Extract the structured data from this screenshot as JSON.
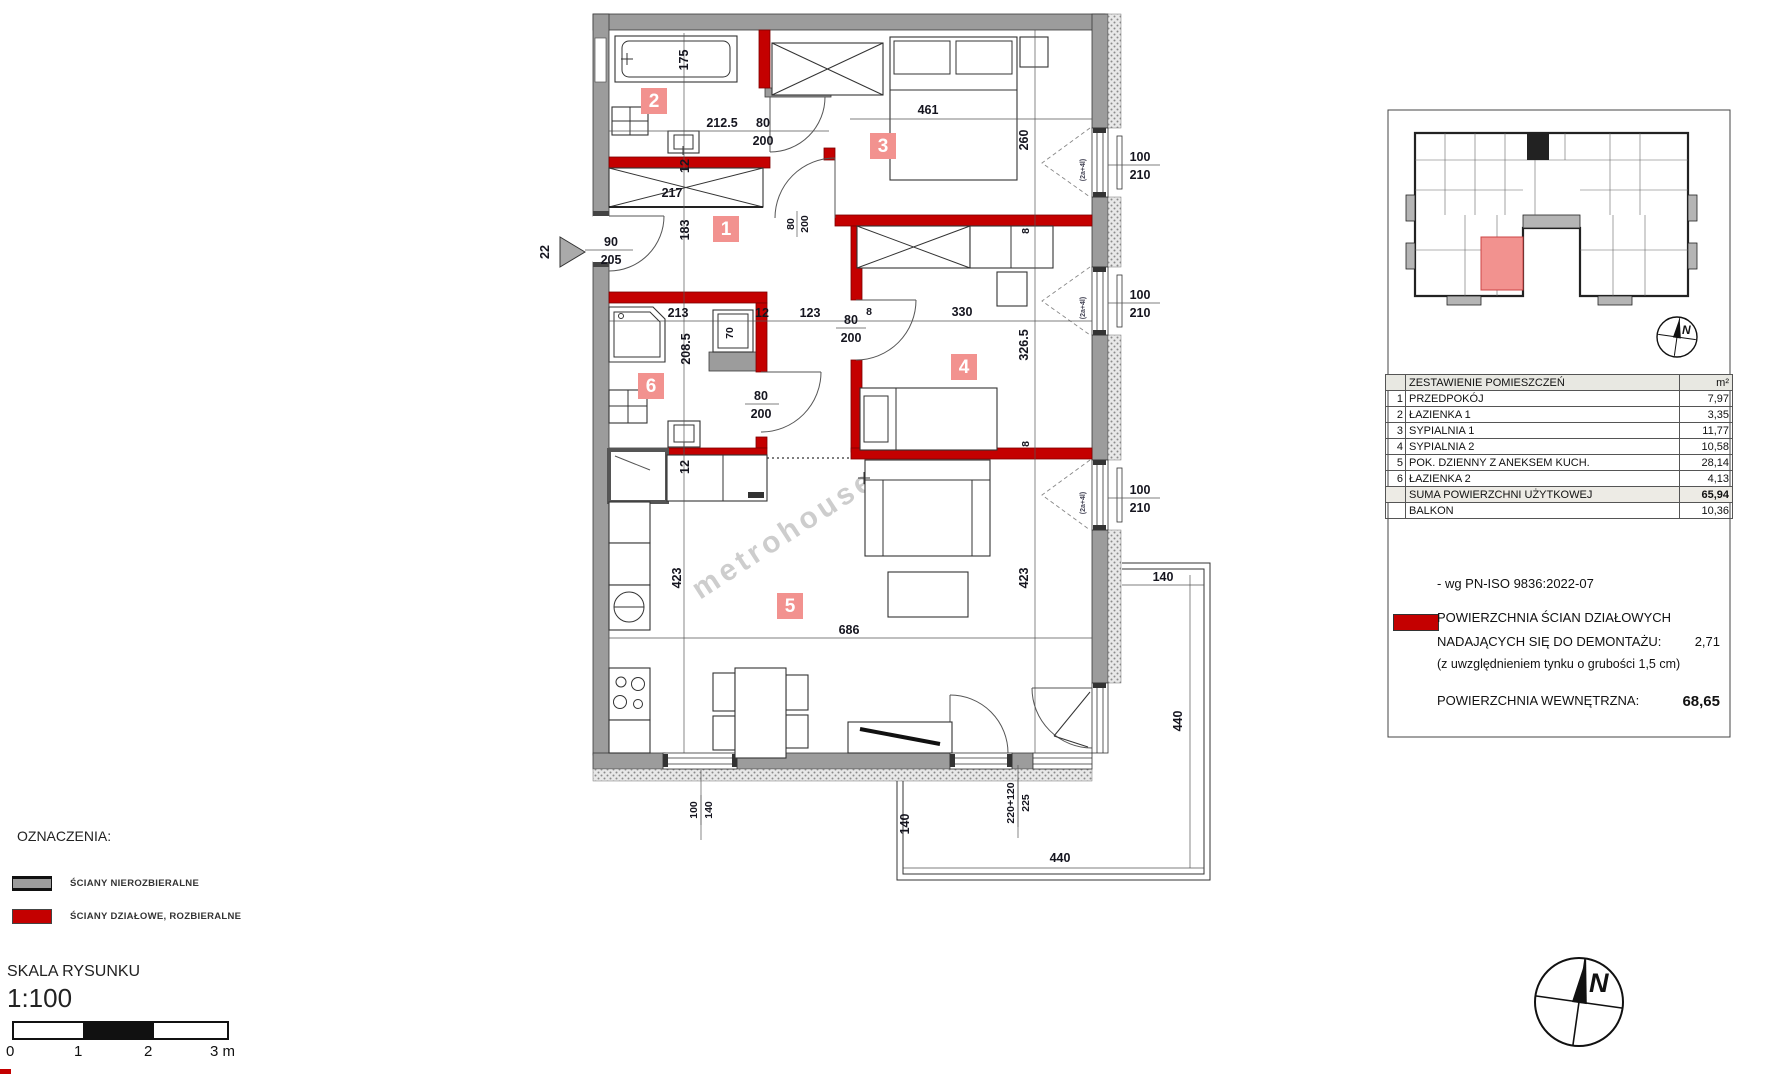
{
  "watermark": "metrohouse",
  "plan": {
    "badges": {
      "b1": "1",
      "b2": "2",
      "b3": "3",
      "b4": "4",
      "b5": "5",
      "b6": "6"
    },
    "labels": {
      "tub": "175",
      "w2125": "212.5",
      "w217": "217",
      "t12": "12",
      "h183": "183",
      "w213": "213",
      "h2085": "208.5",
      "wm70": "70",
      "w123": "123",
      "w461": "461",
      "h260": "260",
      "w330": "330",
      "h3265": "326.5",
      "t8": "8",
      "h423": "423",
      "w686": "686",
      "b_top": "140",
      "b_right": "440",
      "b_bottom": "440",
      "b_left": "140"
    },
    "doors": {
      "w80": "80",
      "h200": "200",
      "e90": "90",
      "e205": "205",
      "no22": "22",
      "win_w": "100",
      "win_h": "210",
      "bw_w": "100",
      "bw_h": "140",
      "bd_top": "220+120",
      "bd_bot": "225",
      "win_note": "(2a+4l)"
    }
  },
  "panel": {
    "table": {
      "header": {
        "name": "ZESTAWIENIE POMIESZCZEŃ",
        "unit": "m²"
      },
      "rows": [
        {
          "no": "1",
          "name": "PRZEDPOKÓJ",
          "area": "7,97"
        },
        {
          "no": "2",
          "name": "ŁAZIENKA 1",
          "area": "3,35"
        },
        {
          "no": "3",
          "name": "SYPIALNIA 1",
          "area": "11,77"
        },
        {
          "no": "4",
          "name": "SYPIALNIA 2",
          "area": "10,58"
        },
        {
          "no": "5",
          "name": "POK. DZIENNY Z ANEKSEM KUCH.",
          "area": "28,14"
        },
        {
          "no": "6",
          "name": "ŁAZIENKA 2",
          "area": "4,13"
        }
      ],
      "sum": {
        "name": "SUMA POWIERZCHNI UŻYTKOWEJ",
        "area": "65,94"
      },
      "balkon": {
        "name": "BALKON",
        "area": "10,36"
      }
    },
    "notes": {
      "norm": "- wg PN-ISO 9836:2022-07",
      "demontaz1": "POWIERZCHNIA ŚCIAN DZIAŁOWYCH",
      "demontaz2": "NADAJĄCYCH SIĘ DO DEMONTAŻU:",
      "demontaz_val": "2,71",
      "demontaz3": "(z uwzględnieniem tynku o grubości 1,5 cm)",
      "internal": "POWIERZCHNIA WEWNĘTRZNA:",
      "internal_val": "68,65"
    },
    "compass_n": "N"
  },
  "legend": {
    "title": "OZNACZENIA:",
    "items": [
      {
        "label": "ŚCIANY NIEROZBIERALNE"
      },
      {
        "label": "ŚCIANY DZIAŁOWE, ROZBIERALNE"
      }
    ],
    "scale_title": "SKALA RYSUNKU",
    "scale": "1:100",
    "ticks": [
      "0",
      "1",
      "2",
      "3 m"
    ]
  },
  "compass": {
    "n": "N"
  },
  "colors": {
    "wall_gray": "#9c9c9c",
    "wall_red": "#c40000",
    "badge_pink": "#f2928f"
  }
}
